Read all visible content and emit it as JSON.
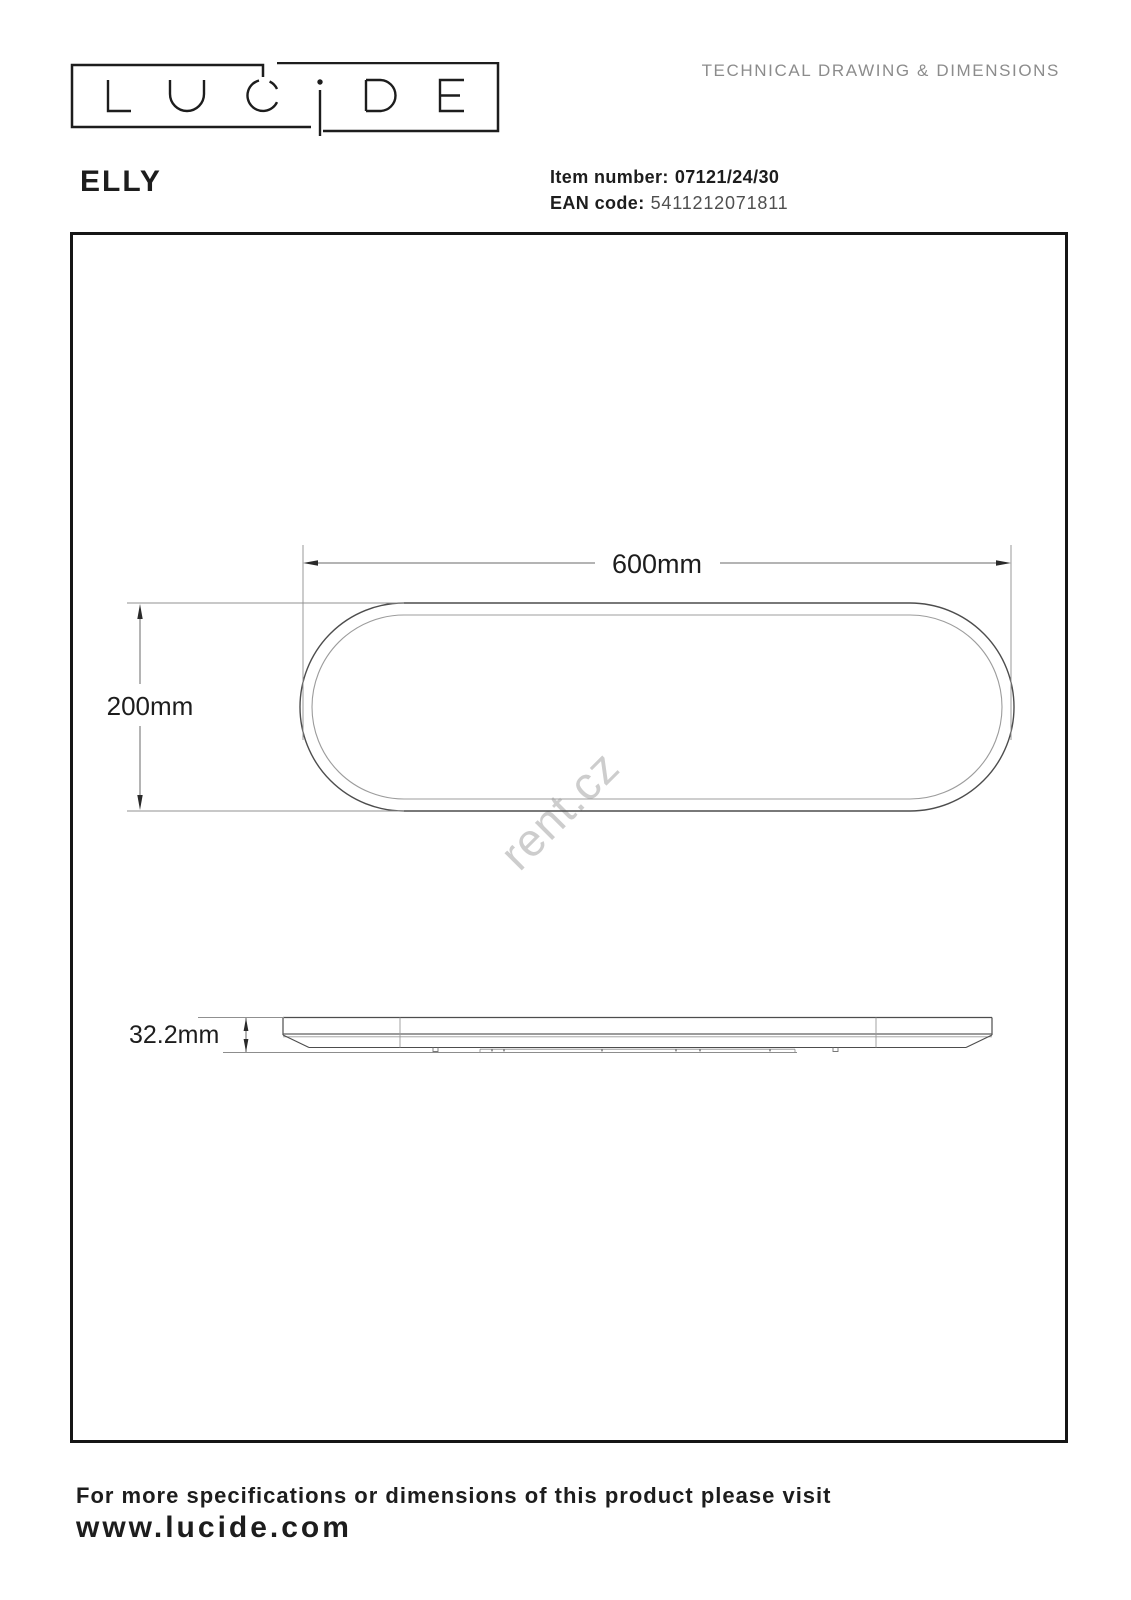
{
  "header": {
    "logo_text": "LUCIDE",
    "doc_title": "TECHNICAL DRAWING & DIMENSIONS",
    "product_name": "ELLY",
    "item_number_label": "Item number:",
    "item_number_value": "07121/24/30",
    "ean_label": "EAN code:",
    "ean_value": "5411212071811"
  },
  "drawing": {
    "dim_width": "600mm",
    "dim_height": "200mm",
    "dim_thickness": "32.2mm",
    "watermark": "rent.cz"
  },
  "footer": {
    "note": "For more specifications or dimensions of this product please visit",
    "website": "www.lucide.com"
  }
}
